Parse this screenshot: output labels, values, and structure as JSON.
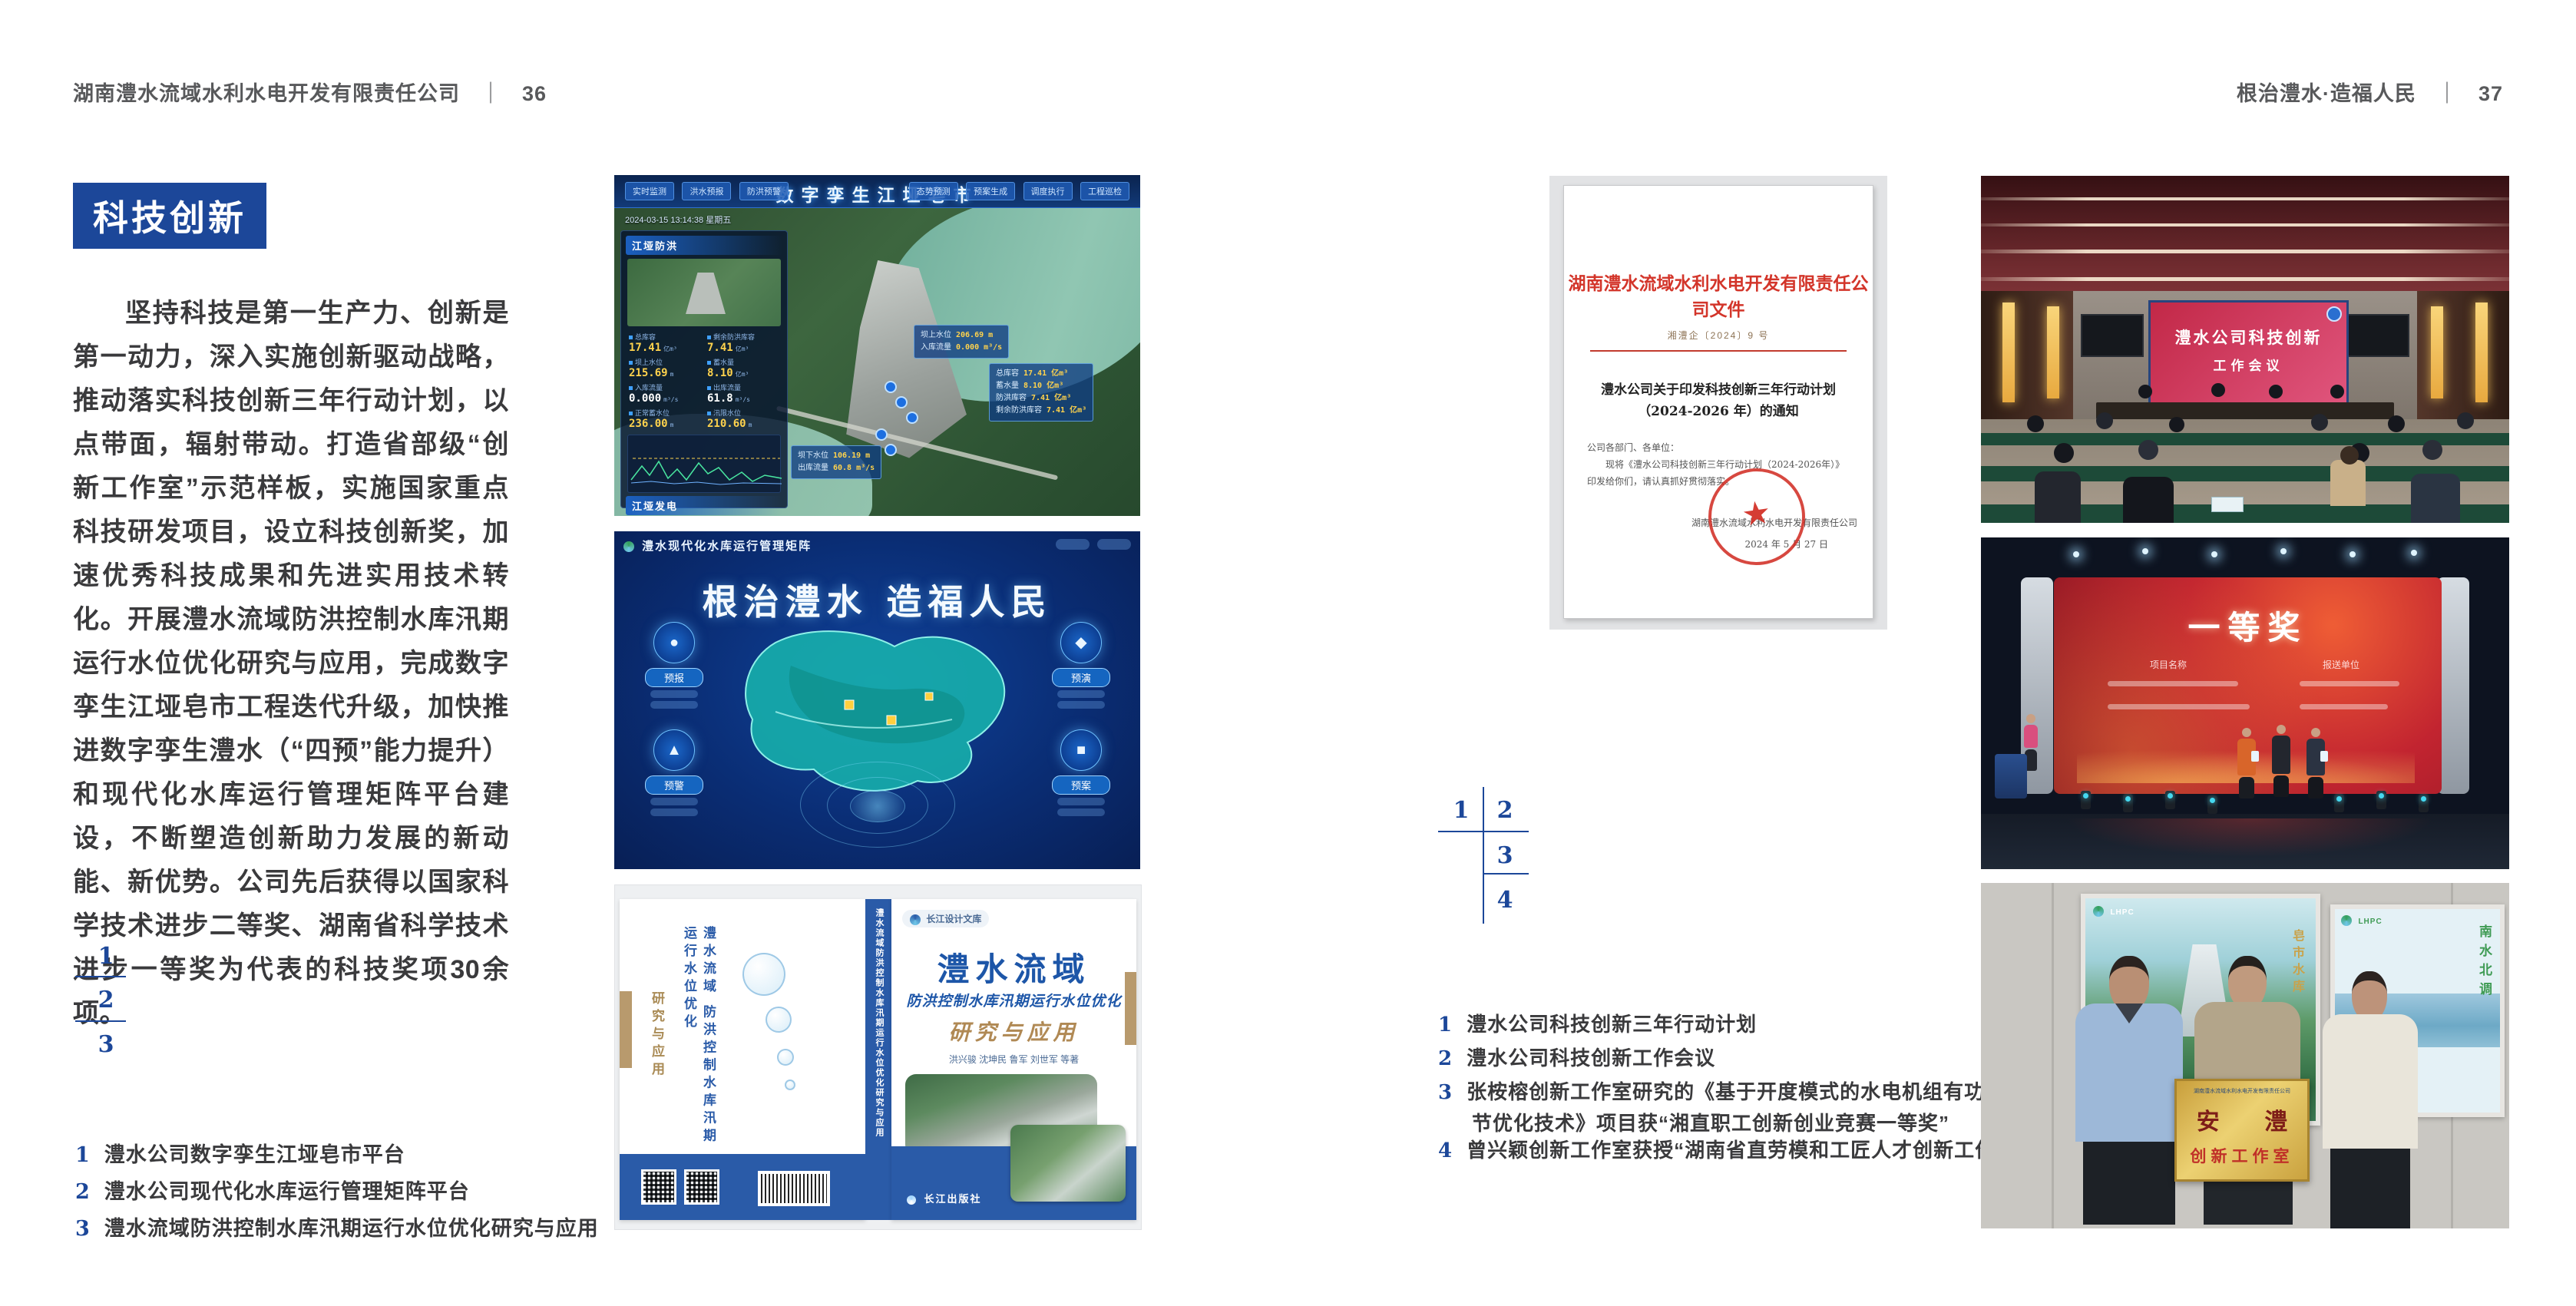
{
  "accent": "#1c4799",
  "left": {
    "header": {
      "company": "湖南澧水流域水利水电开发有限责任公司",
      "divider": "｜",
      "page": "36"
    },
    "badge": "科技创新",
    "body": "坚持科技是第一生产力、创新是第一动力，深入实施创新驱动战略，推动落实科技创新三年行动计划，以点带面，辐射带动。打造省部级“创新工作室”示范样板，实施国家重点科技研发项目，设立科技创新奖，加速优秀科技成果和先进实用技术转化。开展澧水流域防洪控制水库汛期运行水位优化研究与应用，完成数字孪生江垭皂市工程迭代升级，加快推进数字孪生澧水（“四预”能力提升）和现代化水库运行管理矩阵平台建设，不断塑造创新助力发展的新动能、新优势。公司先后获得以国家科学技术进步二等奖、湖南省科学技术进步一等奖为代表的科技奖项30余项。",
    "figure_nums": [
      "1",
      "2",
      "3"
    ],
    "captions": [
      {
        "num": "1",
        "text": "澧水公司数字孪生江垭皂市平台"
      },
      {
        "num": "2",
        "text": "澧水公司现代化水库运行管理矩阵平台"
      },
      {
        "num": "3",
        "text": "澧水流域防洪控制水库汛期运行水位优化研究与应用"
      }
    ],
    "dashboard": {
      "title": "数字孪生江垭皂市",
      "tabs_left": [
        "实时监测",
        "洪水预报",
        "防洪预警"
      ],
      "tabs_right": [
        "态势预测",
        "预案生成",
        "调度执行",
        "工程巡检"
      ],
      "timestamp": "2024-03-15 13:14:38 星期五",
      "panel1_title": "江垭防洪",
      "stats": [
        {
          "label": "总库容",
          "value": "17.41",
          "unit": "亿m³"
        },
        {
          "label": "剩余防洪库容",
          "value": "7.41",
          "unit": "亿m³"
        },
        {
          "label": "坝上水位",
          "value": "215.69",
          "unit": "m"
        },
        {
          "label": "蓄水量",
          "value": "8.10",
          "unit": "亿m³"
        },
        {
          "label": "入库流量",
          "value": "0.000",
          "unit": "m³/s"
        },
        {
          "label": "出库流量",
          "value": "61.8",
          "unit": "m³/s"
        },
        {
          "label": "正常蓄水位",
          "value": "236.00",
          "unit": "m"
        },
        {
          "label": "汛限水位",
          "value": "210.60",
          "unit": "m"
        }
      ],
      "panel2_title": "江垭发电",
      "stats2": [
        {
          "label": "年发电量",
          "value": "6.3000",
          "unit": "亿kWh"
        },
        {
          "label": "年累计发电量",
          "value": "1.2907",
          "unit": "亿kWh"
        },
        {
          "label": "月累计发电量",
          "value": "3359.21",
          "unit": "万kWh"
        },
        {
          "label": "当前出力",
          "value": "0.00",
          "unit": "MW"
        }
      ],
      "callout1": {
        "l1": "坝上水位",
        "v1": "206.69 m",
        "l2": "入库流量",
        "v2": "0.000 m³/s"
      },
      "callout2": [
        {
          "l": "总库容",
          "v": "17.41 亿m³"
        },
        {
          "l": "蓄水量",
          "v": "8.10 亿m³"
        },
        {
          "l": "防洪库容",
          "v": "7.41 亿m³"
        },
        {
          "l": "剩余防洪库容",
          "v": "7.41 亿m³"
        }
      ],
      "callout3": {
        "l1": "坝下水位",
        "v1": "106.19 m",
        "l2": "出库流量",
        "v2": "60.8 m³/s"
      }
    },
    "matrix": {
      "header": "澧水现代化水库运行管理矩阵",
      "slogan": "根治澧水 造福人民",
      "nodes": [
        "预报",
        "预警",
        "预演",
        "预案"
      ]
    },
    "book": {
      "series_badge": "长江设计文库",
      "title_main": "澧水流域",
      "title_sub": "防洪控制水库汛期运行水位优化",
      "title_tail": "研究与应用",
      "authors": "洪兴骏  沈坤民  鲁军  刘世军  等著",
      "publisher": "长江出版社",
      "spine_text": "澧水流域防洪控制水库汛期运行水位优化研究与应用",
      "back_title": "澧水流域 防洪控制水库汛期运行水位优化",
      "back_tail": "研究与应用"
    }
  },
  "right": {
    "header": {
      "motto": "根治澧水·造福人民",
      "divider": "｜",
      "page": "37"
    },
    "document": {
      "masthead": "湖南澧水流域水利水电开发有限责任公司文件",
      "doc_no": "湘澧企〔2024〕9 号",
      "subject1": "澧水公司关于印发科技创新三年行动计划",
      "subject2": "（2024-2026 年）的通知",
      "salutation": "公司各部门、各单位：",
      "body": "现将《澧水公司科技创新三年行动计划（2024-2026年）》印发给你们，请认真抓好贯彻落实。",
      "signer": "湖南澧水流域水利水电开发有限责任公司",
      "date": "2024 年 5 月 27 日"
    },
    "meeting": {
      "screen_line1": "澧水公司科技创新",
      "screen_line2": "工作会议"
    },
    "award": {
      "title": "一等奖",
      "col1": "项目名称",
      "col2": "报送单位"
    },
    "plaque": {
      "header": "湖南澧水流域水利水电开发有限责任公司",
      "line1": "安 澧",
      "line2": "创新工作室",
      "poster_logo": "LHPC",
      "poster_left_text": "皂市水库",
      "poster_right_text": "南水北调"
    },
    "figure_nums": [
      "1",
      "2",
      "3",
      "4"
    ],
    "captions": [
      {
        "num": "1",
        "text": "澧水公司科技创新三年行动计划"
      },
      {
        "num": "2",
        "text": "澧水公司科技创新工作会议"
      },
      {
        "num": "3",
        "text": "张桉榕创新工作室研究的《基于开度模式的水电机组有功调节优化技术》项目获“湘直职工创新创业竞赛一等奖”"
      },
      {
        "num": "4",
        "text": "曾兴颖创新工作室获授“湖南省直劳模和工匠人才创新工作室”"
      }
    ]
  }
}
